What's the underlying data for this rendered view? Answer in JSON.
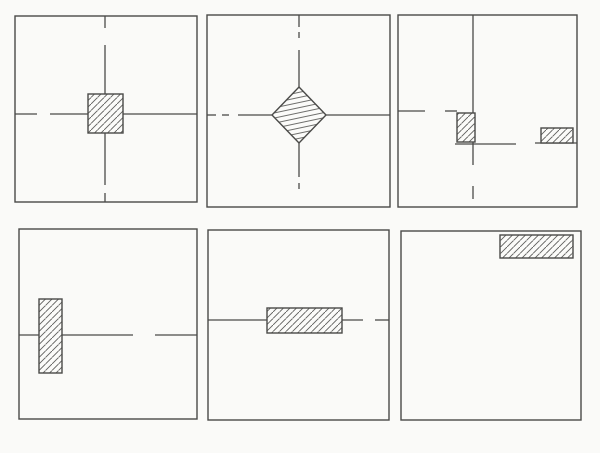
{
  "figure": {
    "name": "six-panel-hatched-shapes-figure",
    "width": 600,
    "height": 453,
    "colors": {
      "background": "#fafaf8",
      "ink": "#4a4a48",
      "hatch": "#5e5e5c",
      "shape_fill": "#fbfbf9"
    },
    "hatch_styles": {
      "diag": {
        "spacing": 6.5,
        "stroke_width": 0.9,
        "direction": "forward-slash"
      },
      "flat": {
        "spacing": 5,
        "stroke_width": 0.9,
        "rotate_deg": -12,
        "direction": "near-horizontal"
      }
    },
    "stroke_widths": {
      "border": 1.4,
      "segment": 1.3,
      "shape_outline": 1.4
    },
    "panels": [
      {
        "id": "panel-1",
        "label": "hatched-square-on-dashed-crosshair",
        "border": [
          15,
          16,
          197,
          202
        ],
        "segments": [
          [
            105,
            16,
            105,
            28
          ],
          [
            105,
            45,
            105,
            94
          ],
          [
            15,
            114,
            37,
            114
          ],
          [
            50,
            114,
            88,
            114
          ],
          [
            123,
            114,
            197,
            114
          ],
          [
            105,
            133,
            105,
            185
          ],
          [
            105,
            193,
            105,
            202
          ]
        ],
        "shapes": [
          {
            "type": "rect",
            "label": "hatched-square",
            "x": 88,
            "y": 94,
            "w": 35,
            "h": 39,
            "hatch": "diag"
          }
        ]
      },
      {
        "id": "panel-2",
        "label": "hatched-diamond-on-dashed-crosshair",
        "border": [
          207,
          15,
          390,
          207
        ],
        "segments": [
          [
            299,
            15,
            299,
            27
          ],
          [
            299,
            32,
            299,
            38
          ],
          [
            299,
            50,
            299,
            88
          ],
          [
            207,
            115,
            216,
            115
          ],
          [
            222,
            115,
            229,
            115
          ],
          [
            238,
            115,
            272,
            115
          ],
          [
            325,
            115,
            390,
            115
          ],
          [
            299,
            143,
            299,
            177
          ],
          [
            299,
            183,
            299,
            189
          ]
        ],
        "shapes": [
          {
            "type": "diamond",
            "label": "hatched-diamond",
            "cx": 299,
            "cy": 115,
            "rx": 27,
            "ry": 28,
            "hatch": "flat"
          }
        ]
      },
      {
        "id": "panel-3",
        "label": "two-small-hatched-rects-on-offset-lines",
        "border": [
          398,
          15,
          577,
          207
        ],
        "segments": [
          [
            473,
            15,
            473,
            165
          ],
          [
            473,
            186,
            473,
            199
          ],
          [
            398,
            111,
            425,
            111
          ],
          [
            445,
            111,
            457,
            111
          ],
          [
            455,
            144,
            516,
            144
          ],
          [
            535,
            143,
            577,
            143
          ]
        ],
        "shapes": [
          {
            "type": "rect",
            "label": "hatched-rect-left",
            "x": 457,
            "y": 113,
            "w": 18,
            "h": 29,
            "hatch": "diag"
          },
          {
            "type": "rect",
            "label": "hatched-rect-right",
            "x": 541,
            "y": 128,
            "w": 32,
            "h": 15,
            "hatch": "diag"
          }
        ]
      },
      {
        "id": "panel-4",
        "label": "vertical-hatched-bar-on-dashed-horizontal",
        "border": [
          19,
          229,
          197,
          419
        ],
        "segments": [
          [
            19,
            335,
            39,
            335
          ],
          [
            62,
            335,
            133,
            335
          ],
          [
            155,
            335,
            197,
            335
          ]
        ],
        "shapes": [
          {
            "type": "rect",
            "label": "hatched-vertical-bar",
            "x": 39,
            "y": 299,
            "w": 23,
            "h": 74,
            "hatch": "diag"
          }
        ]
      },
      {
        "id": "panel-5",
        "label": "horizontal-hatched-bar-on-dashed-horizontal",
        "border": [
          208,
          230,
          389,
          420
        ],
        "segments": [
          [
            208,
            320,
            267,
            320
          ],
          [
            342,
            320,
            363,
            320
          ],
          [
            375,
            320,
            389,
            320
          ]
        ],
        "shapes": [
          {
            "type": "rect",
            "label": "hatched-horizontal-bar",
            "x": 267,
            "y": 308,
            "w": 75,
            "h": 25,
            "hatch": "diag"
          }
        ]
      },
      {
        "id": "panel-6",
        "label": "hatched-bar-at-top-right-empty-square",
        "border": [
          401,
          231,
          581,
          420
        ],
        "segments": [],
        "shapes": [
          {
            "type": "rect",
            "label": "hatched-top-right-bar",
            "x": 500,
            "y": 235,
            "w": 73,
            "h": 23,
            "hatch": "diag"
          }
        ]
      }
    ]
  }
}
